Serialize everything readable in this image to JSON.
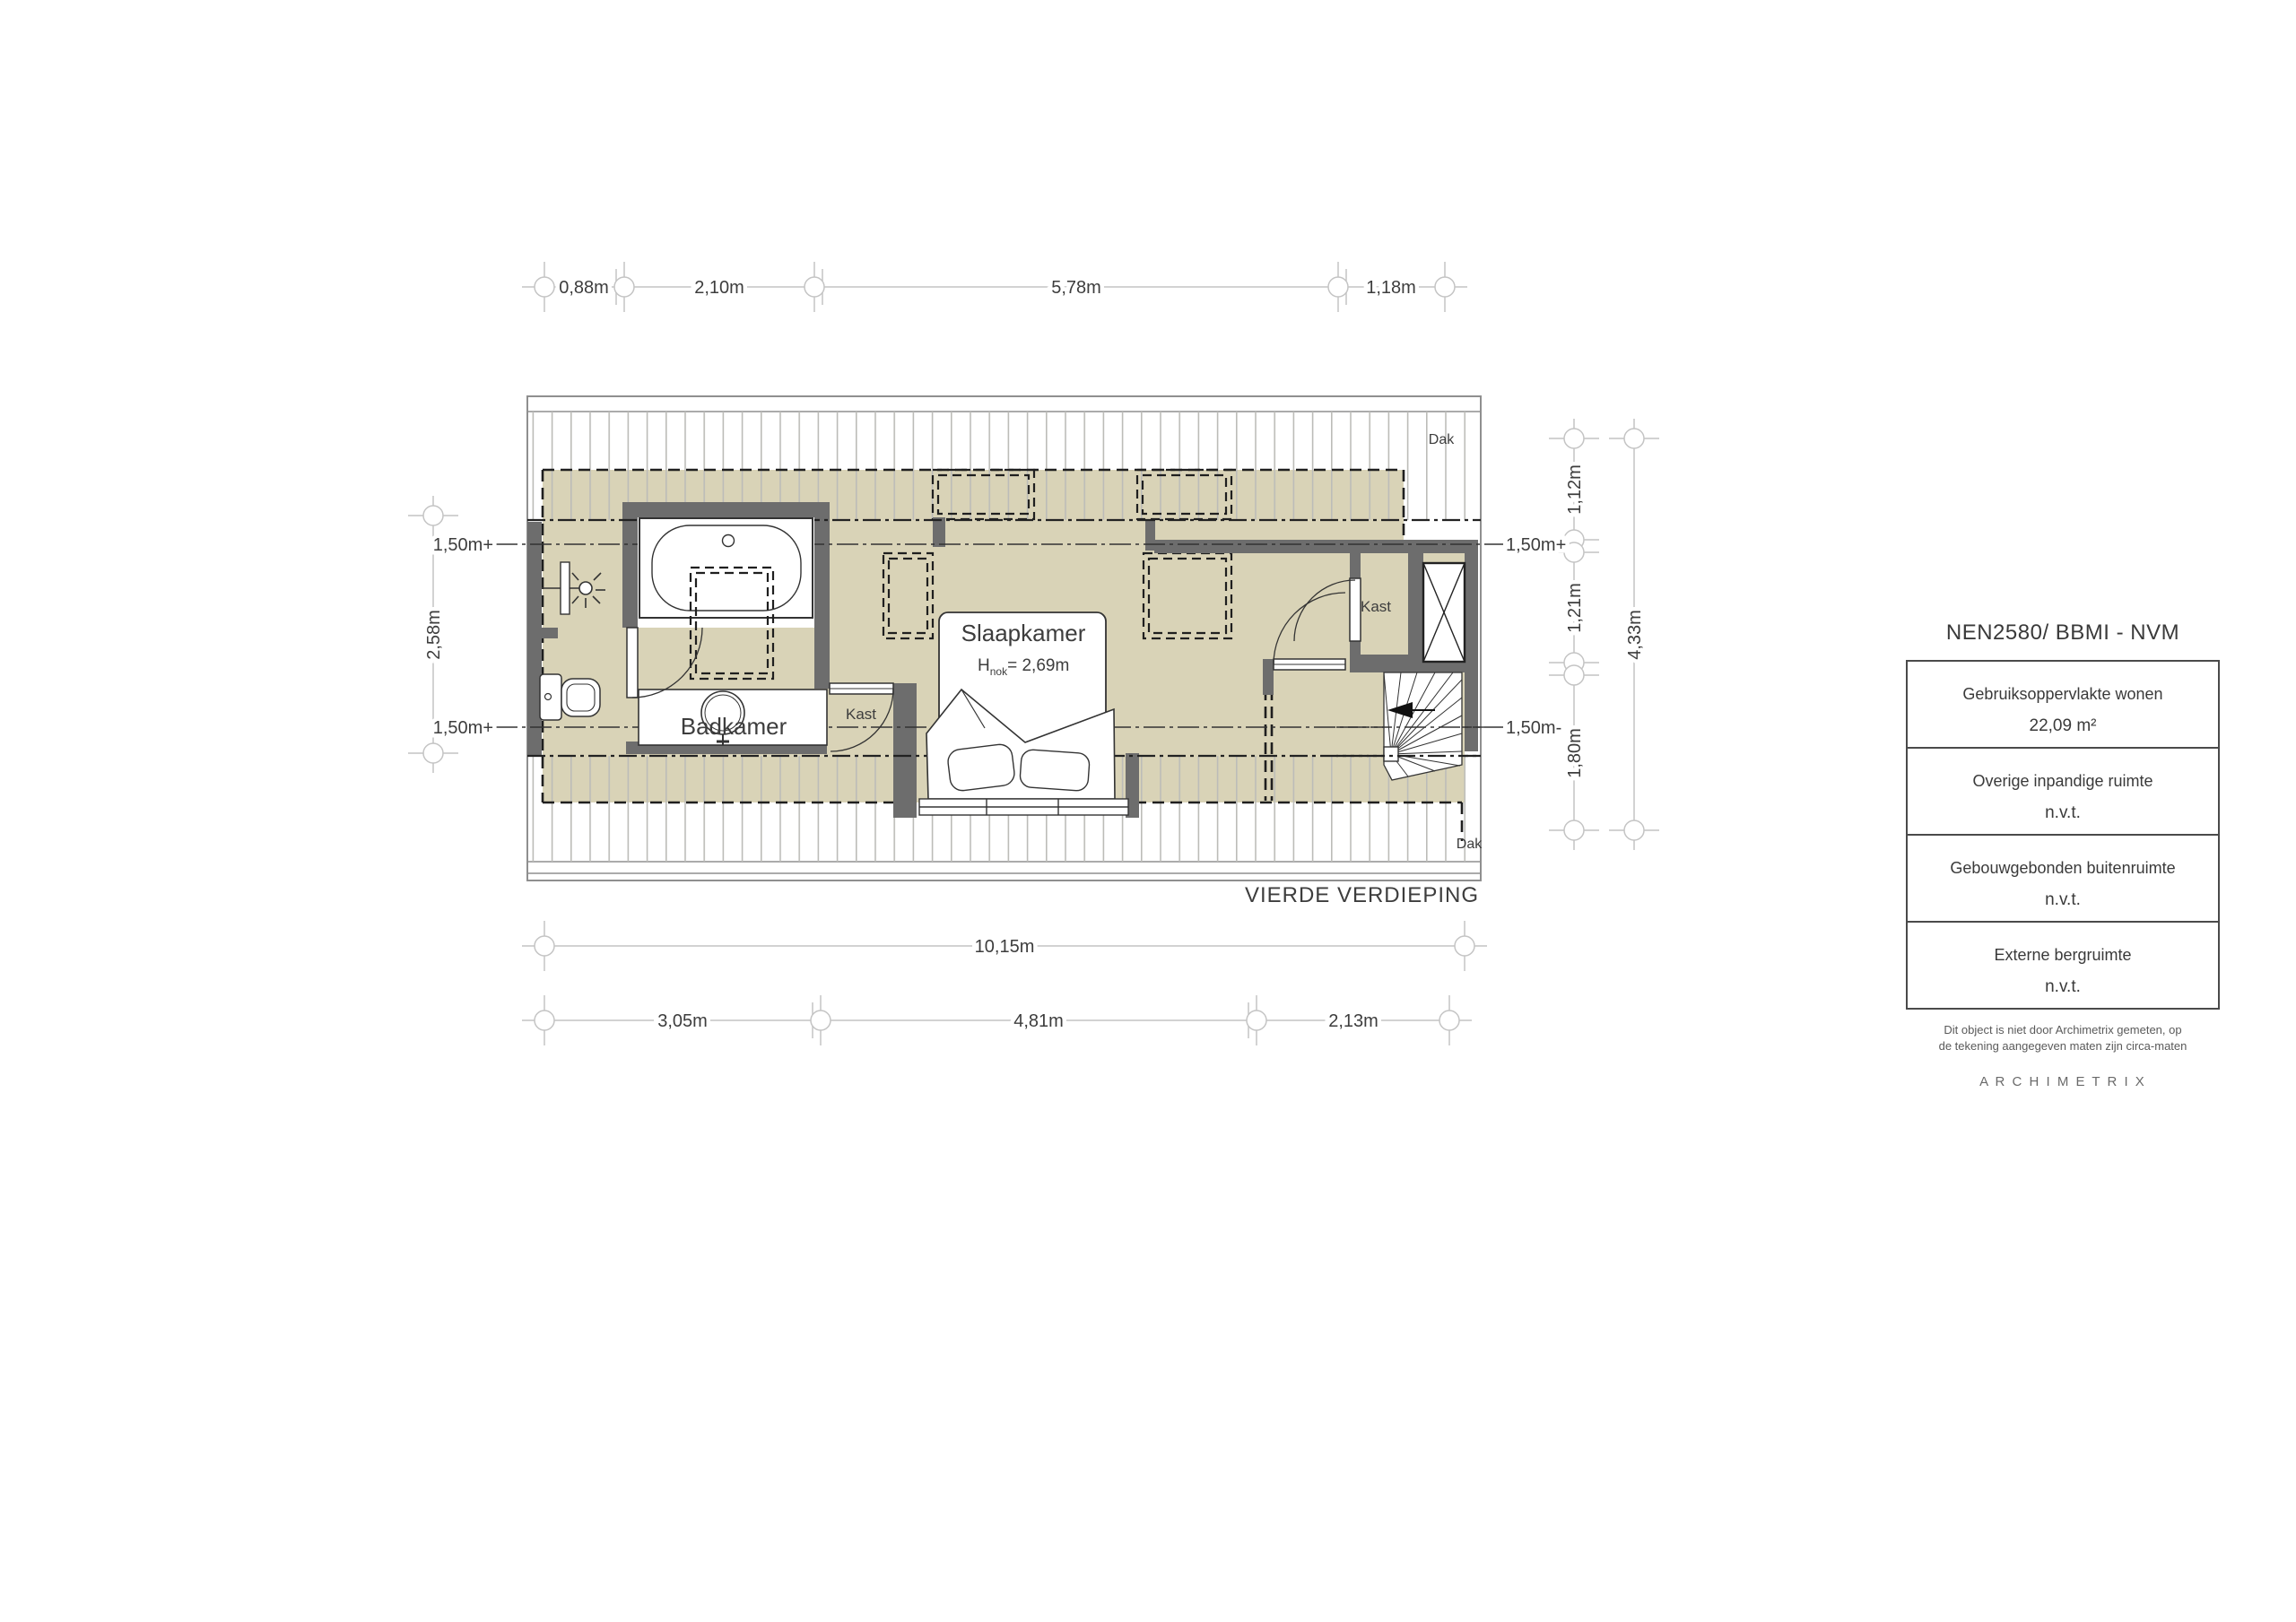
{
  "floor_label": "VIERDE VERDIEPING",
  "rooms": {
    "badkamer": "Badkamer",
    "slaapkamer": "Slaapkamer",
    "hnok": {
      "h": "H",
      "sub": "nok",
      "value": "= 2,69m"
    },
    "kast_hall": "Kast",
    "kast_right": "Kast",
    "dak_top": "Dak",
    "dak_bottom": "Dak"
  },
  "dimensions": {
    "top": [
      "0,88m",
      "2,10m",
      "5,78m",
      "1,18m"
    ],
    "bottom_total": "10,15m",
    "bottom": [
      "3,05m",
      "4,81m",
      "2,13m"
    ],
    "left": "2,58m",
    "right": [
      "1,12m",
      "1,21m",
      "1,80m"
    ],
    "right_total": "4,33m"
  },
  "height_markers": {
    "left_top": "1,50m+",
    "left_bottom": "1,50m+",
    "right_top": "1,50m+",
    "right_bottom": "1,50m-"
  },
  "legend": {
    "title": "NEN2580/ BBMI - NVM",
    "rows": [
      {
        "label": "Gebruiksoppervlakte wonen",
        "value": "22,09 m²"
      },
      {
        "label": "Overige inpandige ruimte",
        "value": "n.v.t."
      },
      {
        "label": "Gebouwgebonden buitenruimte",
        "value": "n.v.t."
      },
      {
        "label": "Externe bergruimte",
        "value": "n.v.t."
      }
    ],
    "footnote1": "Dit object is niet door Archimetrix gemeten, op",
    "footnote2": "de tekening aangegeven maten zijn circa-maten",
    "brand": "A R C H I M E T R I X"
  }
}
